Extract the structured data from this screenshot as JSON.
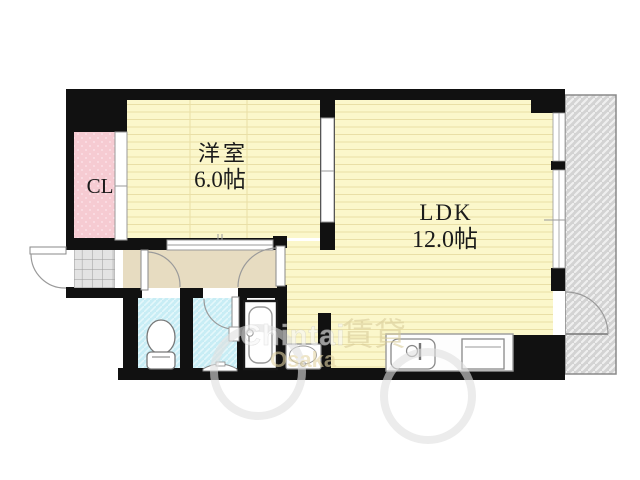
{
  "floorplan": {
    "type": "apartment-floor-plan",
    "labels": {
      "closet": "CL",
      "western_room_name": "洋室",
      "western_room_size": "6.0帖",
      "ldk_name": "LDK",
      "ldk_size": "12.0帖"
    },
    "watermark": {
      "brand_latin": "Chintai",
      "brand_latin2": "Osaka",
      "brand_kanji": "賃貸"
    },
    "colors": {
      "wall": "#111111",
      "floor_yellow": "#FBF7CB",
      "floor_line": "#E9DFA6",
      "closet_pink": "#F6CBD2",
      "wet_area_cyan": "#C8EDF5",
      "wet_area_hatch": "#E4F7FB",
      "corridor_beige": "#E7DCC1",
      "balcony_gray": "#D3D3D3",
      "balcony_hatch": "#EFEFEF",
      "entry_tile_gray": "#E3E3E3",
      "fixture_stroke": "#888888",
      "label_text": "#1b1b1b"
    }
  }
}
